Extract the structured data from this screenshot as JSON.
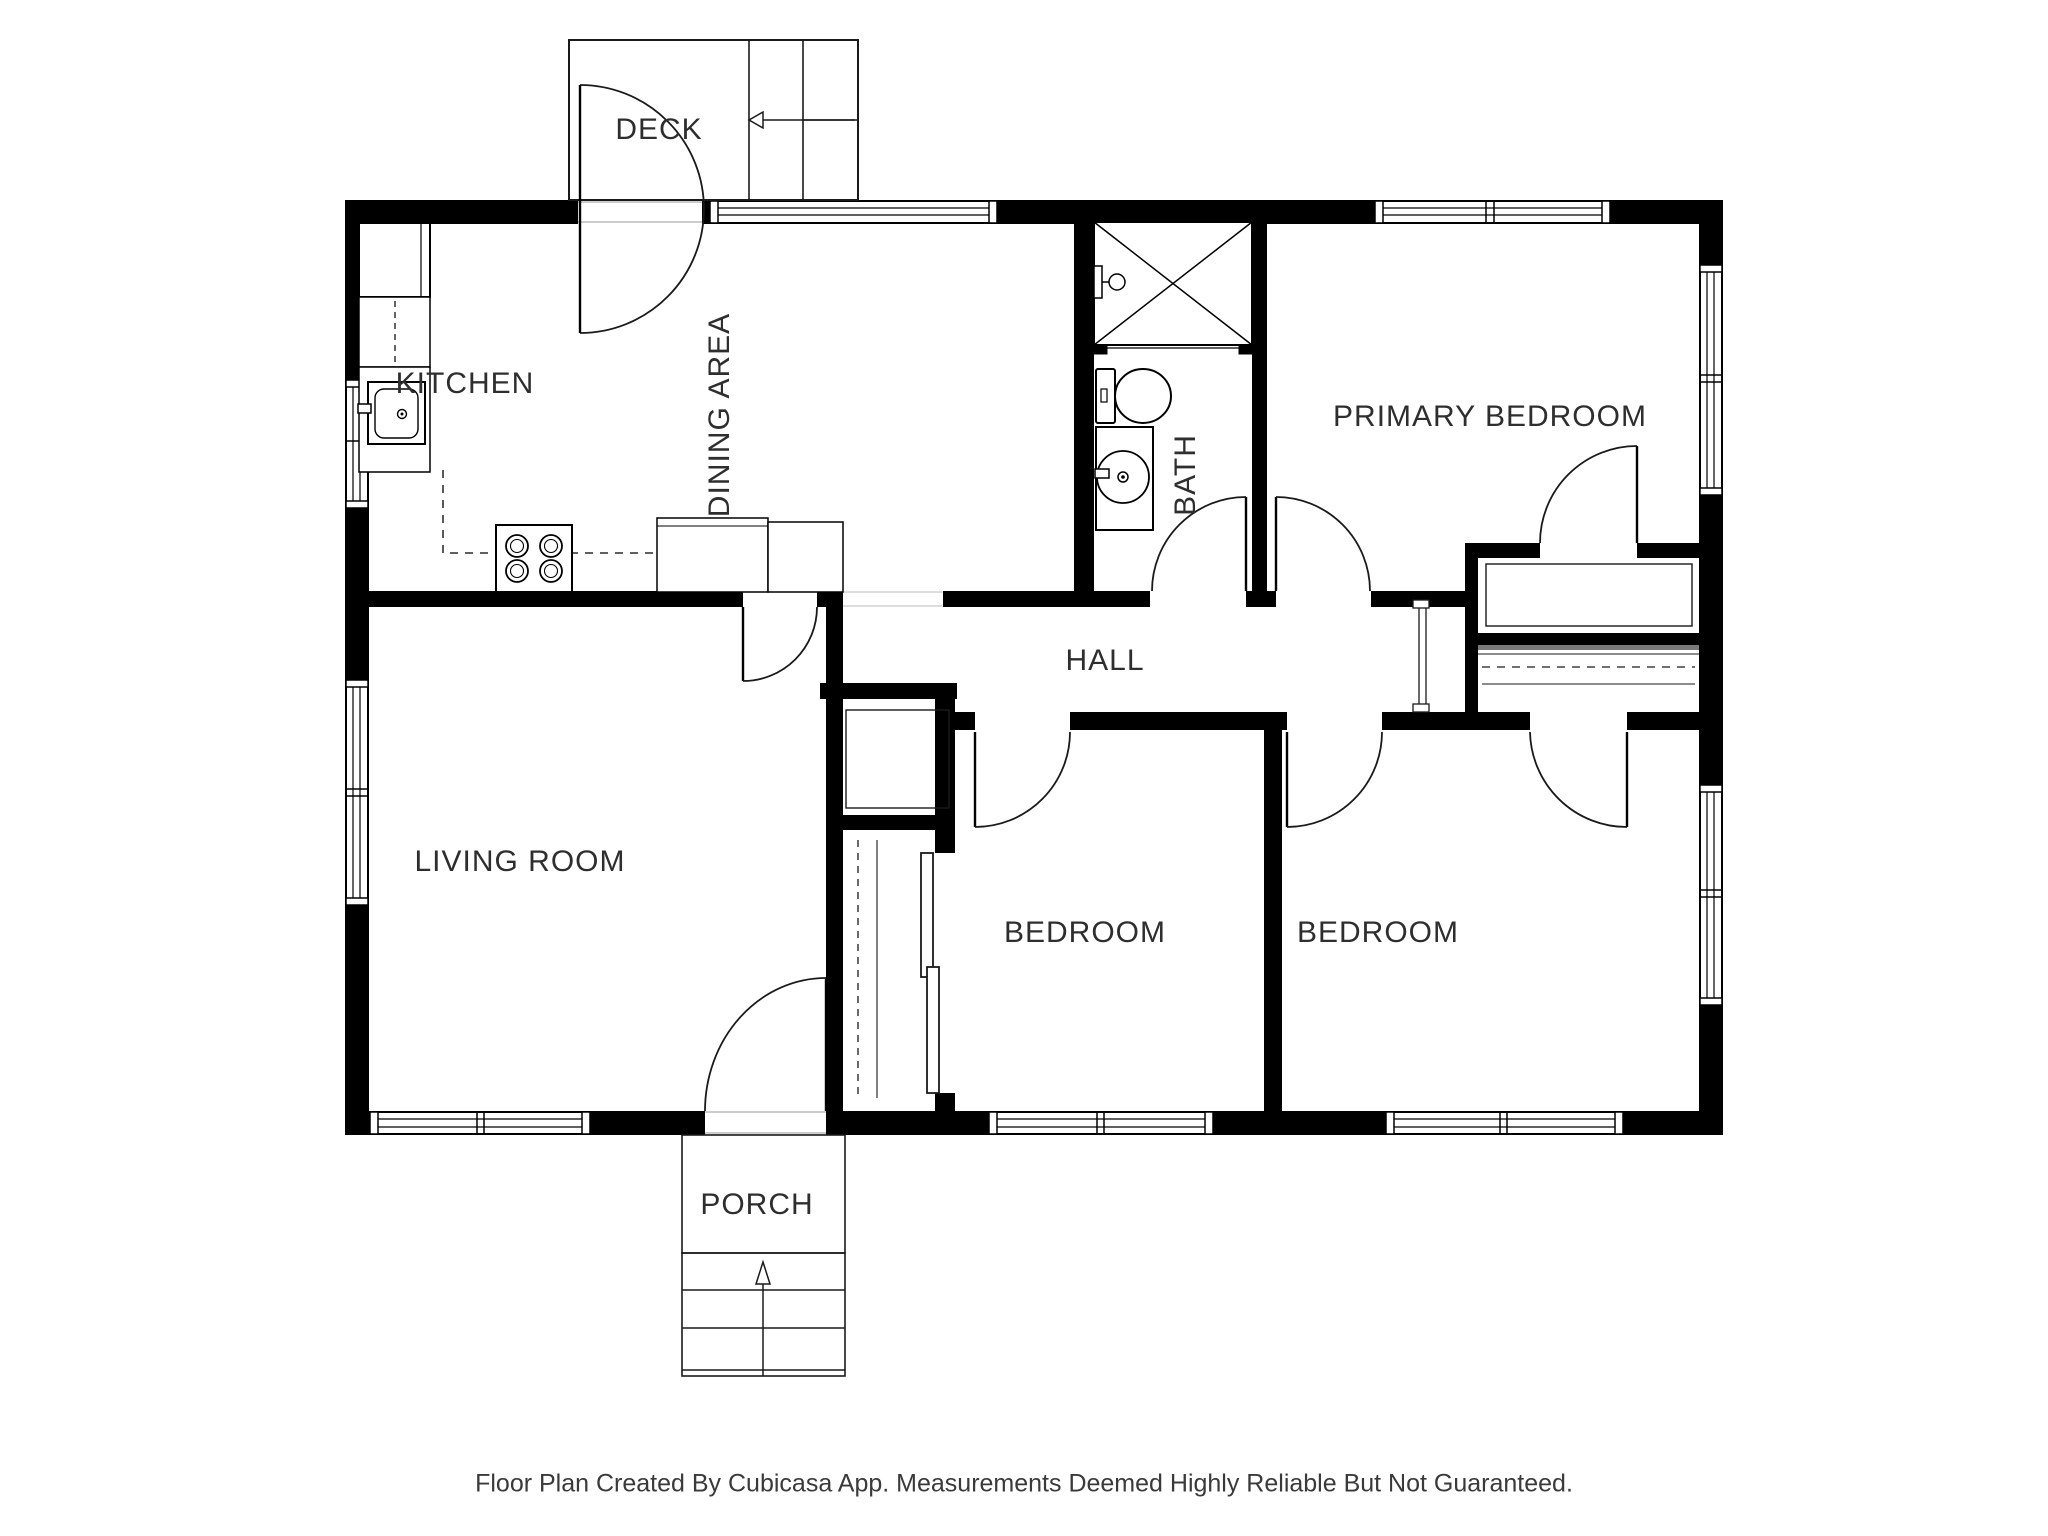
{
  "floor_plan": {
    "labels": {
      "deck": "DECK",
      "kitchen": "KITCHEN",
      "dining": "DINING AREA",
      "bath": "BATH",
      "primary_bedroom": "PRIMARY BEDROOM",
      "hall": "HALL",
      "living_room": "LIVING ROOM",
      "bedroom_left": "BEDROOM",
      "bedroom_right": "BEDROOM",
      "porch": "PORCH"
    },
    "footer": "Floor Plan Created By Cubicasa App. Measurements Deemed Highly Reliable But Not Guaranteed.",
    "colors": {
      "wall": "#000000",
      "line": "#1a1a1a",
      "threshold": "#999999",
      "text": "#2e2e2e",
      "background": "#ffffff"
    },
    "icons": [
      "stairs-icon",
      "stair-direction-arrow-icon",
      "entry-arrow-icon",
      "door-swing-icon",
      "window-icon",
      "shower-icon",
      "shower-head-icon",
      "toilet-icon",
      "vanity-sink-icon",
      "refrigerator-icon",
      "dishwasher-icon",
      "kitchen-sink-icon",
      "stove-icon",
      "kitchen-counter-icon",
      "closet-rod-icon",
      "closet-shelf-icon",
      "sliding-door-icon"
    ]
  }
}
